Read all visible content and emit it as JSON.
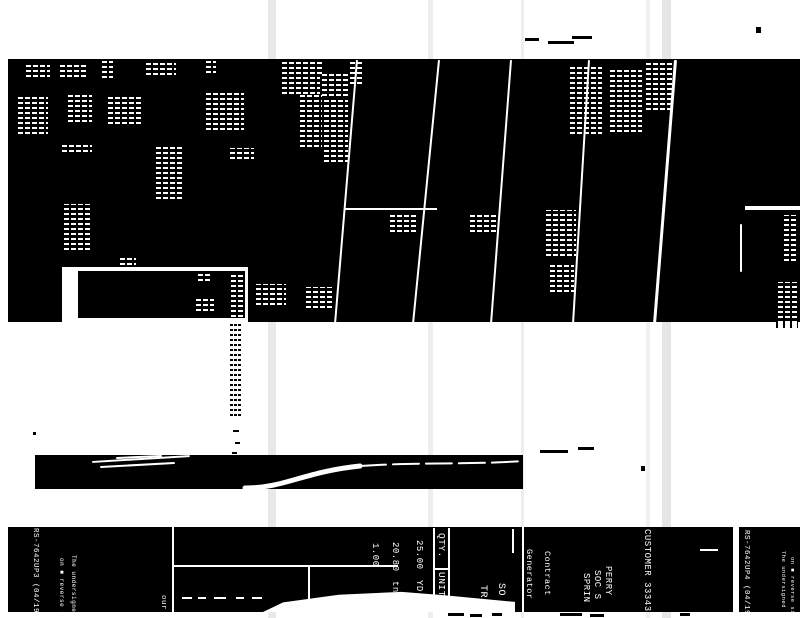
{
  "document": {
    "kind": "scanned receipt, rotated 90 degrees, high-contrast degraded scan",
    "colors": {
      "paper": "#ffffff",
      "ink": "#000000",
      "inverted_text": "#ffffff",
      "fold_streak": "#8f8f8f"
    }
  },
  "receipt": {
    "customer_line": "CUSTOMER 33343",
    "address_lines": [
      "PERRY",
      "SOC S",
      "SPRIN"
    ],
    "field_labels": [
      "Contract",
      "Generator"
    ],
    "partial_items": [
      "SO",
      "TR"
    ],
    "table": {
      "headers": [
        "QTY.",
        "UNIT"
      ],
      "rows": [
        {
          "qty": "25.00",
          "unit": "YD"
        },
        {
          "qty": "20.80",
          "unit": "tn"
        },
        {
          "qty": "1.00",
          "unit": ""
        }
      ]
    },
    "form_number_left": "RS-7642UP3 (04/19)",
    "form_number_right": "RS-7642UP4 (04/19)",
    "fine_print_line1": "The undersigned h",
    "fine_print_line2": "on ■ reverse side",
    "misc_text": "our b"
  },
  "scan_artifacts": {
    "fold_streaks": [
      [
        268,
        8,
        0.2
      ],
      [
        428,
        5,
        0.15
      ],
      [
        521,
        3,
        0.15
      ],
      [
        646,
        4,
        0.12
      ],
      [
        662,
        9,
        0.22
      ]
    ],
    "noise_blobs": [
      [
        24,
        64,
        26,
        13
      ],
      [
        58,
        62,
        30,
        15
      ],
      [
        100,
        60,
        13,
        18
      ],
      [
        144,
        60,
        32,
        15
      ],
      [
        204,
        60,
        12,
        13
      ],
      [
        280,
        61,
        42,
        33
      ],
      [
        320,
        74,
        28,
        22
      ],
      [
        16,
        94,
        32,
        40
      ],
      [
        66,
        94,
        26,
        28
      ],
      [
        106,
        94,
        36,
        30
      ],
      [
        204,
        92,
        40,
        38
      ],
      [
        298,
        95,
        24,
        52
      ],
      [
        322,
        100,
        26,
        62
      ],
      [
        60,
        143,
        32,
        9
      ],
      [
        154,
        145,
        28,
        54
      ],
      [
        228,
        148,
        26,
        11
      ],
      [
        62,
        204,
        28,
        46
      ],
      [
        118,
        256,
        18,
        9
      ],
      [
        348,
        60,
        16,
        24
      ],
      [
        388,
        212,
        28,
        20
      ],
      [
        468,
        212,
        28,
        20
      ],
      [
        544,
        210,
        32,
        46
      ],
      [
        548,
        262,
        26,
        30
      ],
      [
        568,
        66,
        34,
        68
      ],
      [
        608,
        68,
        34,
        64
      ],
      [
        644,
        62,
        28,
        48
      ],
      [
        782,
        215,
        16,
        46
      ],
      [
        776,
        282,
        22,
        46
      ],
      [
        254,
        284,
        32,
        21
      ],
      [
        304,
        287,
        28,
        21
      ],
      [
        196,
        274,
        16,
        7
      ],
      [
        194,
        298,
        20,
        13
      ],
      [
        229,
        272,
        14,
        45
      ],
      [
        229,
        324,
        13,
        92,
        1
      ]
    ],
    "crease_lines": [
      [
        358,
        60,
        336,
        324,
        2
      ],
      [
        440,
        60,
        414,
        324,
        2
      ],
      [
        512,
        60,
        492,
        324,
        2
      ],
      [
        590,
        60,
        574,
        324,
        2
      ],
      [
        677,
        60,
        656,
        324,
        2.5
      ],
      [
        742,
        224,
        742,
        272,
        2
      ],
      [
        92,
        461,
        190,
        455,
        2
      ],
      [
        100,
        466,
        175,
        462,
        2
      ],
      [
        116,
        457,
        162,
        455,
        1.5
      ]
    ],
    "ink_marks": [
      [
        345,
        208,
        92,
        2,
        0
      ],
      [
        745,
        206,
        55,
        4,
        0
      ],
      [
        700,
        549,
        18,
        2,
        0
      ],
      [
        172,
        527,
        2,
        85,
        0
      ],
      [
        173,
        565,
        225,
        2,
        0
      ],
      [
        182,
        597,
        10,
        2,
        0
      ],
      [
        198,
        597,
        8,
        2,
        0
      ],
      [
        214,
        597,
        12,
        2,
        0
      ],
      [
        236,
        597,
        8,
        2,
        0
      ],
      [
        252,
        597,
        10,
        2,
        0
      ],
      [
        433,
        528,
        1.5,
        70,
        0
      ],
      [
        448,
        528,
        1.5,
        70,
        0
      ],
      [
        433,
        568,
        16,
        1.5,
        0
      ],
      [
        433,
        597,
        16,
        1.5,
        0
      ],
      [
        512,
        529,
        1.5,
        24,
        0
      ],
      [
        522,
        527,
        1.5,
        85,
        0
      ],
      [
        308,
        565,
        1.5,
        47,
        0
      ],
      [
        525,
        38,
        14,
        3,
        1
      ],
      [
        548,
        41,
        26,
        3,
        1
      ],
      [
        572,
        36,
        20,
        3,
        1
      ],
      [
        33,
        432,
        3,
        3,
        1
      ],
      [
        641,
        466,
        4,
        5,
        1
      ],
      [
        756,
        27,
        5,
        6,
        1
      ],
      [
        540,
        450,
        28,
        3,
        1
      ],
      [
        578,
        447,
        16,
        3,
        1
      ],
      [
        448,
        613,
        16,
        3,
        1
      ],
      [
        470,
        614,
        12,
        3,
        1
      ],
      [
        492,
        613,
        10,
        3,
        1
      ],
      [
        560,
        613,
        22,
        3,
        1
      ],
      [
        590,
        614,
        14,
        3,
        1
      ],
      [
        680,
        613,
        10,
        3,
        1
      ],
      [
        233,
        430,
        6,
        2,
        1
      ],
      [
        235,
        442,
        5,
        2,
        1
      ],
      [
        232,
        452,
        5,
        2,
        1
      ]
    ]
  }
}
